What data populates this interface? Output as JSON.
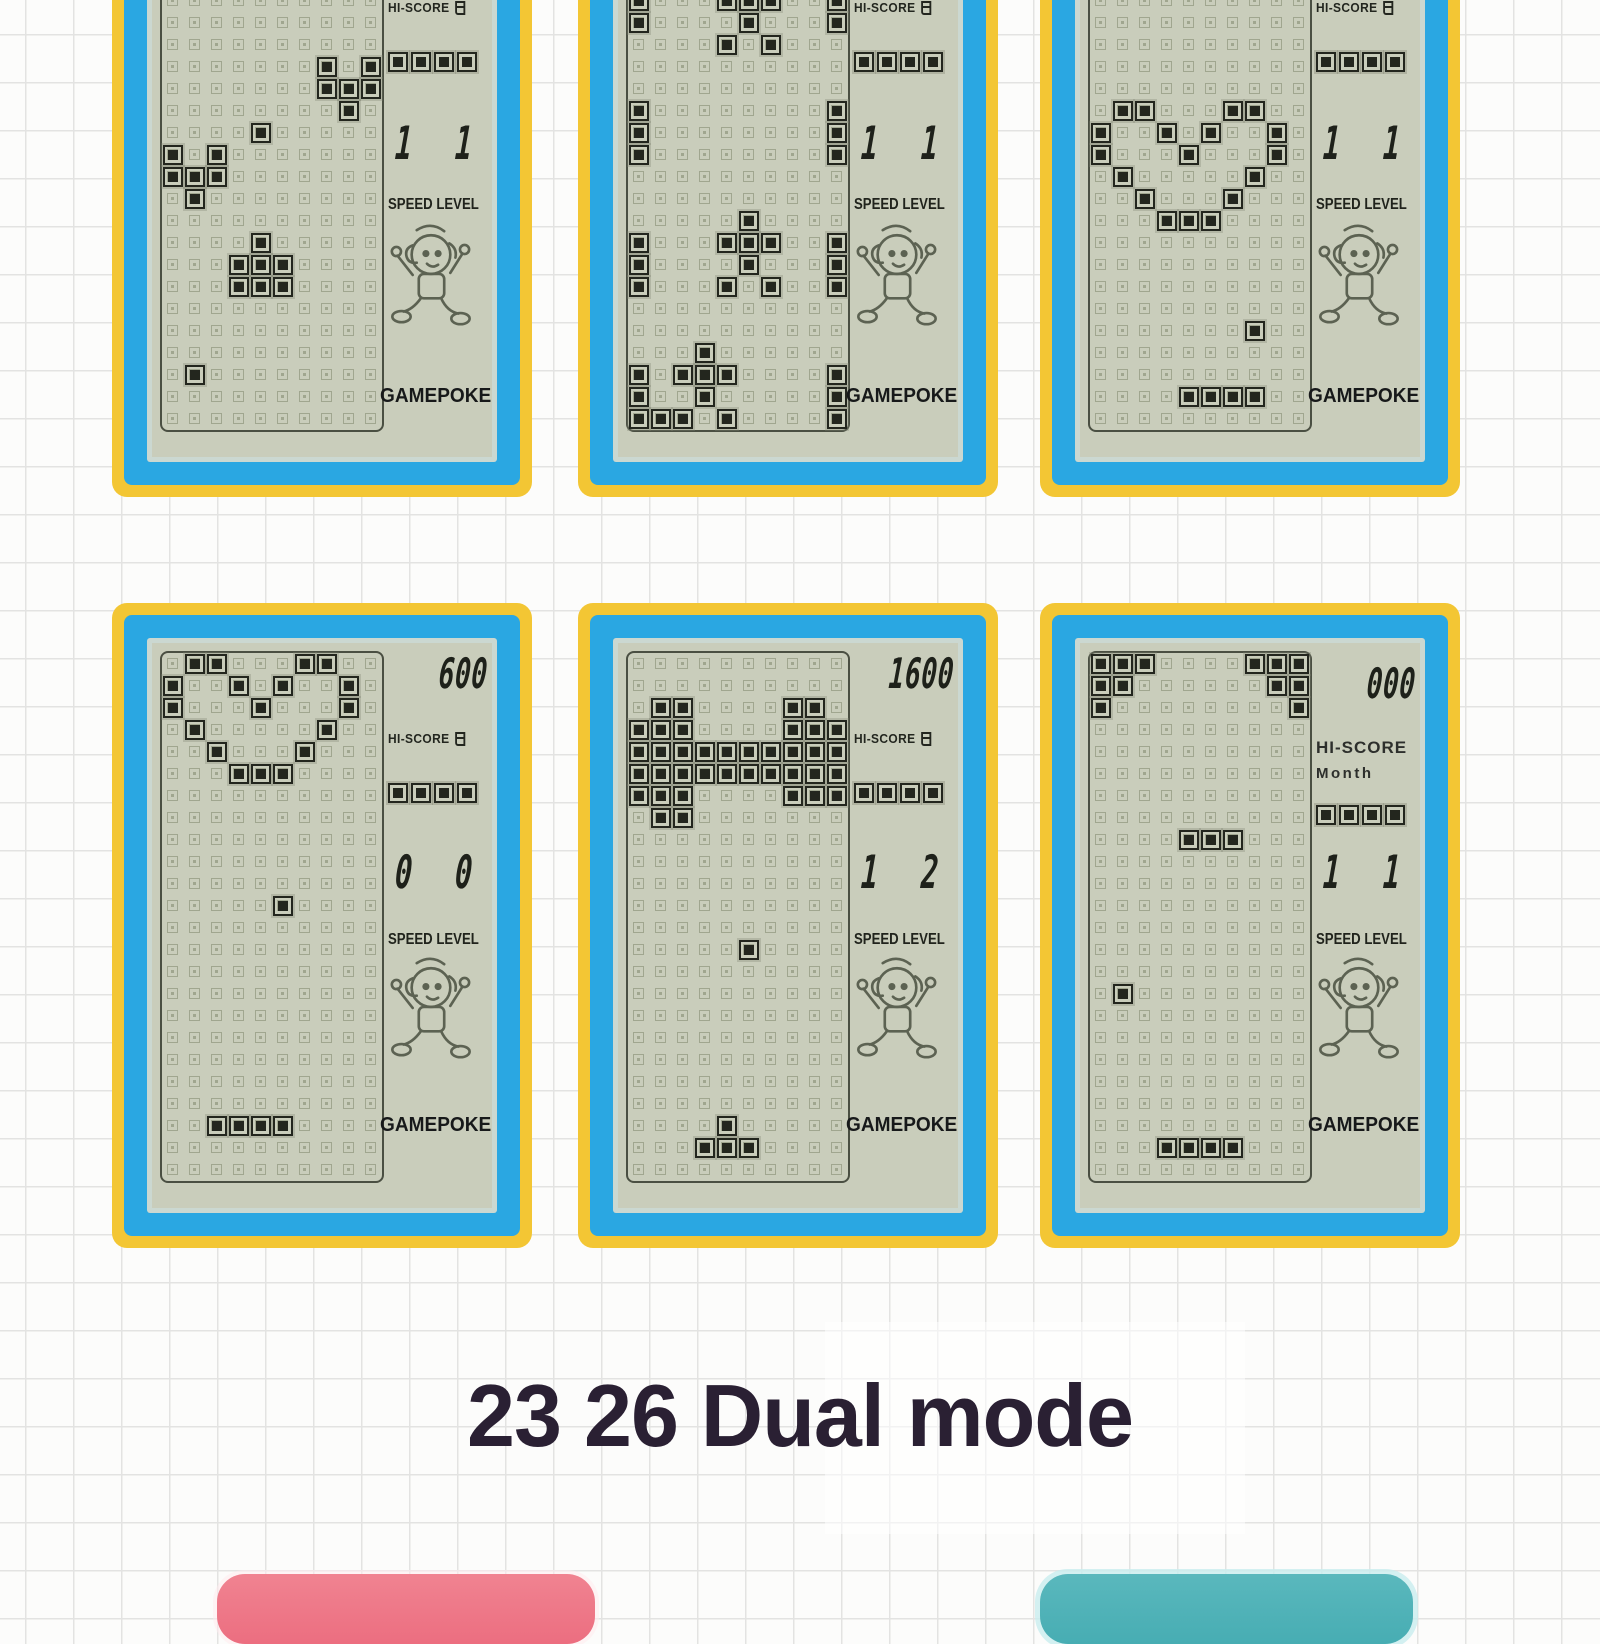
{
  "page": {
    "caption": "23 26 Dual mode"
  },
  "colors": {
    "frame_yellow": "#f3c634",
    "frame_blue": "#2aa7e2",
    "lcd_background": "#c9cdbb",
    "lcd_ink": "#23261e",
    "caption_text": "#2a2033",
    "button_pink": "#ec6e80",
    "button_teal": "#47adb3"
  },
  "buttons": [
    {
      "name": "pink-button",
      "color": "#ec6e80"
    },
    {
      "name": "teal-button",
      "color": "#47adb3"
    }
  ],
  "screens": [
    {
      "name": "screen-top-left",
      "hiscore_label": "HI-SCORE",
      "hiscore_suffix": "月",
      "level": [
        "1",
        "1"
      ],
      "speed_label": "SPEED LEVEL",
      "brand": "GAMEPOKE",
      "next_blocks": 4,
      "grid": {
        "cols": 10,
        "rows": 25,
        "blocks": [
          [
            7,
            8
          ],
          [
            9,
            8
          ],
          [
            7,
            9
          ],
          [
            8,
            9
          ],
          [
            9,
            9
          ],
          [
            8,
            10
          ],
          [
            4,
            11
          ],
          [
            0,
            12
          ],
          [
            2,
            12
          ],
          [
            0,
            13
          ],
          [
            1,
            13
          ],
          [
            2,
            13
          ],
          [
            1,
            14
          ],
          [
            4,
            16
          ],
          [
            3,
            17
          ],
          [
            4,
            17
          ],
          [
            5,
            17
          ],
          [
            3,
            18
          ],
          [
            4,
            18
          ],
          [
            5,
            18
          ],
          [
            1,
            22
          ]
        ]
      }
    },
    {
      "name": "screen-top-middle",
      "hiscore_label": "HI-SCORE",
      "hiscore_suffix": "月",
      "level": [
        "1",
        "1"
      ],
      "speed_label": "SPEED LEVEL",
      "brand": "GAMEPOKE",
      "next_blocks": 4,
      "grid": {
        "cols": 10,
        "rows": 25,
        "blocks": [
          [
            0,
            5
          ],
          [
            0,
            6
          ],
          [
            4,
            5
          ],
          [
            5,
            5
          ],
          [
            6,
            5
          ],
          [
            9,
            5
          ],
          [
            5,
            6
          ],
          [
            9,
            6
          ],
          [
            4,
            7
          ],
          [
            6,
            7
          ],
          [
            0,
            10
          ],
          [
            0,
            11
          ],
          [
            0,
            12
          ],
          [
            9,
            10
          ],
          [
            9,
            11
          ],
          [
            9,
            12
          ],
          [
            5,
            15
          ],
          [
            4,
            16
          ],
          [
            5,
            16
          ],
          [
            6,
            16
          ],
          [
            5,
            17
          ],
          [
            4,
            18
          ],
          [
            6,
            18
          ],
          [
            0,
            16
          ],
          [
            0,
            17
          ],
          [
            0,
            18
          ],
          [
            9,
            16
          ],
          [
            9,
            17
          ],
          [
            9,
            18
          ],
          [
            3,
            21
          ],
          [
            2,
            22
          ],
          [
            3,
            22
          ],
          [
            4,
            22
          ],
          [
            3,
            23
          ],
          [
            0,
            22
          ],
          [
            0,
            23
          ],
          [
            0,
            24
          ],
          [
            9,
            22
          ],
          [
            9,
            23
          ],
          [
            9,
            24
          ],
          [
            1,
            24
          ],
          [
            2,
            24
          ],
          [
            4,
            24
          ]
        ]
      }
    },
    {
      "name": "screen-top-right",
      "hiscore_label": "HI-SCORE",
      "hiscore_suffix": "月",
      "level": [
        "1",
        "1"
      ],
      "speed_label": "SPEED LEVEL",
      "brand": "GAMEPOKE",
      "next_blocks": 4,
      "grid": {
        "cols": 10,
        "rows": 25,
        "blocks": [
          [
            1,
            10
          ],
          [
            2,
            10
          ],
          [
            6,
            10
          ],
          [
            7,
            10
          ],
          [
            0,
            11
          ],
          [
            3,
            11
          ],
          [
            5,
            11
          ],
          [
            8,
            11
          ],
          [
            0,
            12
          ],
          [
            4,
            12
          ],
          [
            8,
            12
          ],
          [
            1,
            13
          ],
          [
            7,
            13
          ],
          [
            2,
            14
          ],
          [
            6,
            14
          ],
          [
            3,
            15
          ],
          [
            4,
            15
          ],
          [
            5,
            15
          ],
          [
            7,
            20
          ],
          [
            4,
            23
          ],
          [
            5,
            23
          ],
          [
            6,
            23
          ],
          [
            7,
            23
          ]
        ]
      }
    },
    {
      "name": "screen-bottom-left",
      "score": "600",
      "hiscore_label": "HI-SCORE",
      "hiscore_suffix": "月",
      "level": [
        "0",
        "0"
      ],
      "speed_label": "SPEED LEVEL",
      "brand": "GAMEPOKE",
      "next_blocks": 4,
      "grid": {
        "cols": 10,
        "rows": 24,
        "blocks": [
          [
            1,
            0
          ],
          [
            2,
            0
          ],
          [
            6,
            0
          ],
          [
            7,
            0
          ],
          [
            0,
            1
          ],
          [
            3,
            1
          ],
          [
            5,
            1
          ],
          [
            8,
            1
          ],
          [
            0,
            2
          ],
          [
            4,
            2
          ],
          [
            8,
            2
          ],
          [
            1,
            3
          ],
          [
            7,
            3
          ],
          [
            2,
            4
          ],
          [
            6,
            4
          ],
          [
            3,
            5
          ],
          [
            4,
            5
          ],
          [
            5,
            5
          ],
          [
            5,
            11
          ],
          [
            2,
            21
          ],
          [
            3,
            21
          ],
          [
            4,
            21
          ],
          [
            5,
            21
          ]
        ]
      }
    },
    {
      "name": "screen-bottom-middle",
      "score": "1600",
      "hiscore_label": "HI-SCORE",
      "hiscore_suffix": "月",
      "level": [
        "1",
        "2"
      ],
      "speed_label": "SPEED LEVEL",
      "brand": "GAMEPOKE",
      "next_blocks": 4,
      "grid": {
        "cols": 10,
        "rows": 24,
        "blocks": [
          [
            1,
            2
          ],
          [
            2,
            2
          ],
          [
            7,
            2
          ],
          [
            8,
            2
          ],
          [
            0,
            3
          ],
          [
            1,
            3
          ],
          [
            2,
            3
          ],
          [
            7,
            3
          ],
          [
            8,
            3
          ],
          [
            9,
            3
          ],
          [
            0,
            4
          ],
          [
            1,
            4
          ],
          [
            2,
            4
          ],
          [
            3,
            4
          ],
          [
            4,
            4
          ],
          [
            5,
            4
          ],
          [
            6,
            4
          ],
          [
            7,
            4
          ],
          [
            8,
            4
          ],
          [
            9,
            4
          ],
          [
            0,
            5
          ],
          [
            1,
            5
          ],
          [
            2,
            5
          ],
          [
            3,
            5
          ],
          [
            4,
            5
          ],
          [
            5,
            5
          ],
          [
            6,
            5
          ],
          [
            7,
            5
          ],
          [
            8,
            5
          ],
          [
            9,
            5
          ],
          [
            0,
            6
          ],
          [
            1,
            6
          ],
          [
            2,
            6
          ],
          [
            7,
            6
          ],
          [
            8,
            6
          ],
          [
            9,
            6
          ],
          [
            1,
            7
          ],
          [
            2,
            7
          ],
          [
            5,
            13
          ],
          [
            4,
            21
          ],
          [
            3,
            22
          ],
          [
            4,
            22
          ],
          [
            5,
            22
          ]
        ]
      }
    },
    {
      "name": "screen-bottom-right",
      "score": "000",
      "hiscore_label": "HI-SCORE",
      "hiscore_sub": "Month",
      "level": [
        "1",
        "1"
      ],
      "speed_label": "SPEED LEVEL",
      "brand": "GAMEPOKE",
      "next_blocks": 4,
      "grid": {
        "cols": 10,
        "rows": 24,
        "blocks": [
          [
            0,
            0
          ],
          [
            1,
            0
          ],
          [
            2,
            0
          ],
          [
            7,
            0
          ],
          [
            8,
            0
          ],
          [
            9,
            0
          ],
          [
            0,
            1
          ],
          [
            1,
            1
          ],
          [
            8,
            1
          ],
          [
            9,
            1
          ],
          [
            0,
            2
          ],
          [
            9,
            2
          ],
          [
            4,
            8
          ],
          [
            5,
            8
          ],
          [
            6,
            8
          ],
          [
            1,
            15
          ],
          [
            3,
            22
          ],
          [
            4,
            22
          ],
          [
            5,
            22
          ],
          [
            6,
            22
          ]
        ]
      }
    }
  ]
}
